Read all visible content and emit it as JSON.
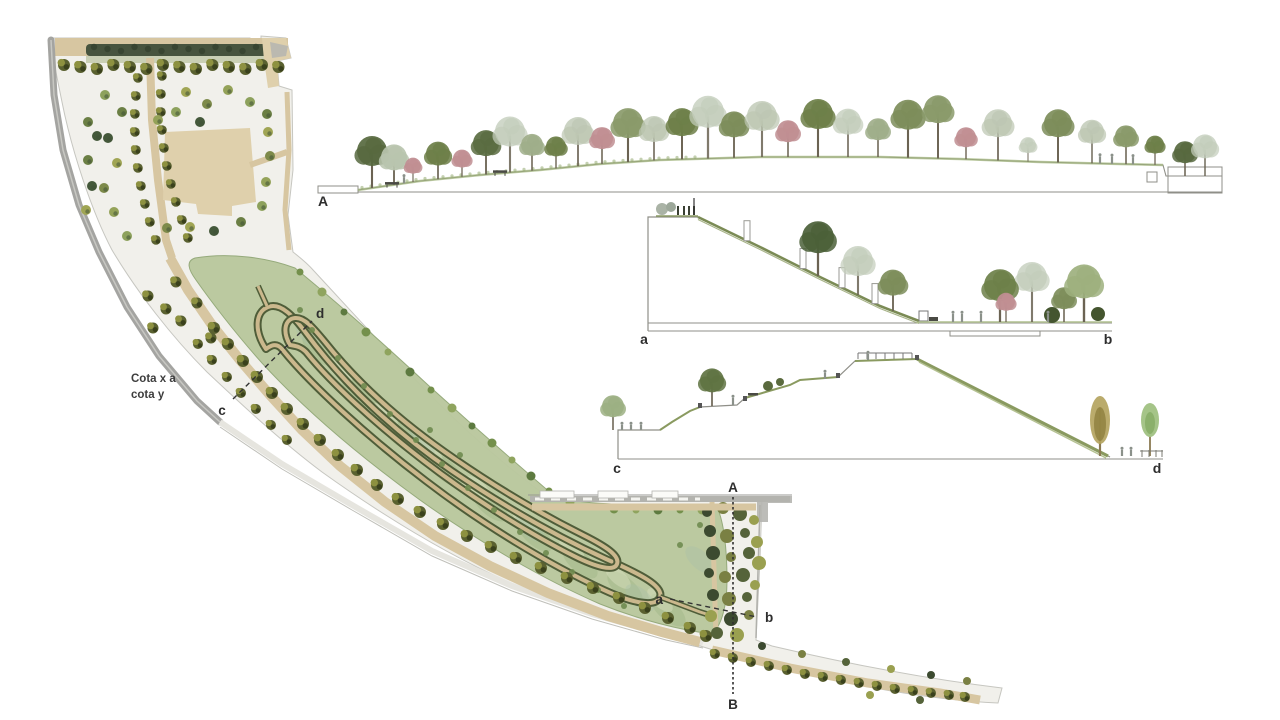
{
  "page": {
    "background": "#ffffff"
  },
  "plan": {
    "annotation": {
      "line1": "Cota x a",
      "line2": "cota y"
    },
    "markers": {
      "A": "A",
      "B": "B",
      "a": "a",
      "b": "b",
      "c": "c",
      "d": "d"
    }
  },
  "sections": {
    "long": {
      "start": "A"
    },
    "ab": {
      "start": "a",
      "end": "b"
    },
    "cd": {
      "start": "c",
      "end": "d"
    }
  },
  "palette": {
    "base": "#f1f0eb",
    "edge": "#c6c6c0",
    "road": "#a4a4a1",
    "road_light": "#e6e5df",
    "tan": "#d7c6a1",
    "tan_dark": "#cbb88d",
    "plaza": "#dfd0ac",
    "hedge": "#47543e",
    "green_band": "#bac89e",
    "green_patch_dark": "#9cb483",
    "green_patch_light": "#d5debc",
    "green_patch_blue": "#a9bfa9",
    "path_edge_dark": "#4f5d39",
    "olive_dark": "#5a6130",
    "olive_mid": "#8d9140",
    "olive_deep": "#3a411c",
    "tree_green": "#6d7f48",
    "tree_dark": "#4b6038",
    "tree_faded": "#c3cdbb",
    "tree_pink": "#c08e92",
    "tree_light": "#9db07e",
    "ground": "#8f8f88",
    "grass": "#9db275",
    "label": "#2e2e2e",
    "figure": "#8b918a"
  }
}
